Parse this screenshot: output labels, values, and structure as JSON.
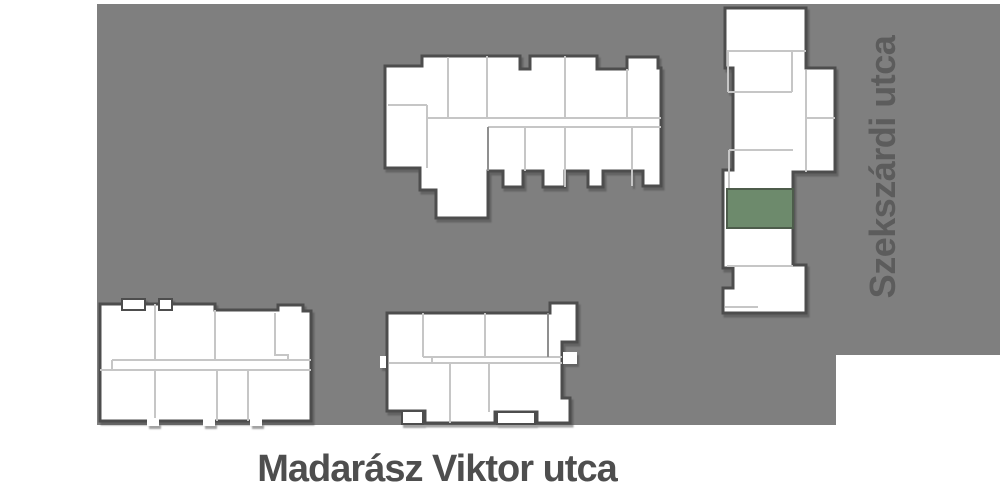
{
  "map": {
    "site_color": "#7f7f7f",
    "building_fill": "#ffffff",
    "outline_color": "#4d4d4d",
    "divider_color": "#c6c6c6",
    "highlight_color": "#6d8a6c"
  },
  "labels": {
    "street_right": "Szekszárdi utca",
    "street_bottom": "Madarász Viktor utca"
  }
}
